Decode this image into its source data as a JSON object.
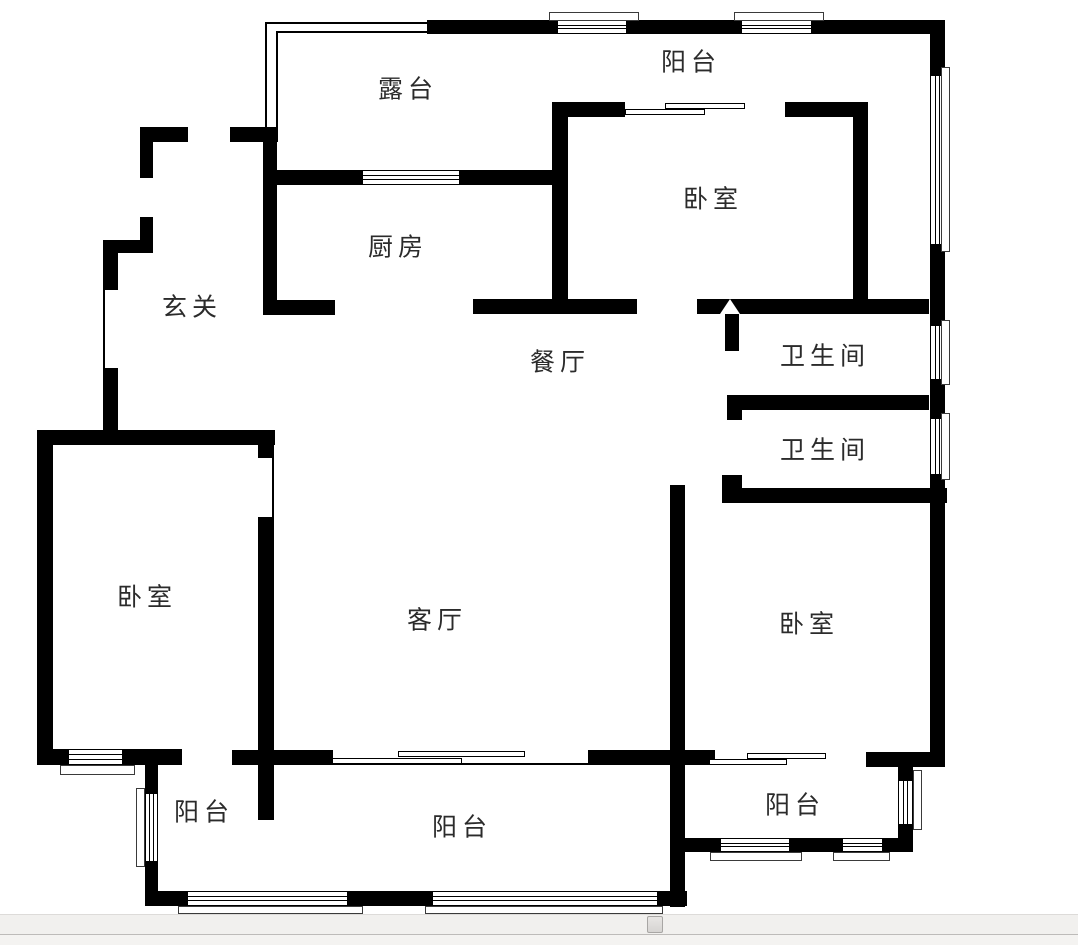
{
  "page": {
    "width": 1078,
    "height": 945,
    "background": "#ffffff"
  },
  "floorplan": {
    "wall_color": "#000000",
    "label_color": "#2b2b2b",
    "rooms": [
      {
        "id": "terrace",
        "label": "露台",
        "x": 408,
        "y": 90
      },
      {
        "id": "balcony-top",
        "label": "阳台",
        "x": 691,
        "y": 63
      },
      {
        "id": "bedroom-ne",
        "label": "卧室",
        "x": 713,
        "y": 200
      },
      {
        "id": "kitchen",
        "label": "厨房",
        "x": 398,
        "y": 248
      },
      {
        "id": "foyer",
        "label": "玄关",
        "x": 192,
        "y": 308
      },
      {
        "id": "dining-room",
        "label": "餐厅",
        "x": 560,
        "y": 363
      },
      {
        "id": "bathroom-upper",
        "label": "卫生间",
        "x": 825,
        "y": 357
      },
      {
        "id": "bathroom-lower",
        "label": "卫生间",
        "x": 825,
        "y": 451
      },
      {
        "id": "bedroom-west",
        "label": "卧室",
        "x": 147,
        "y": 598
      },
      {
        "id": "living-room",
        "label": "客厅",
        "x": 437,
        "y": 621
      },
      {
        "id": "bedroom-se",
        "label": "卧室",
        "x": 809,
        "y": 625
      },
      {
        "id": "balcony-sw",
        "label": "阳台",
        "x": 204,
        "y": 813
      },
      {
        "id": "balcony-s",
        "label": "阳台",
        "x": 462,
        "y": 828
      },
      {
        "id": "balcony-se",
        "label": "阳台",
        "x": 795,
        "y": 806
      }
    ],
    "geometry": {
      "walls": [
        [
          427,
          20,
          130,
          14
        ],
        [
          627,
          20,
          114,
          14
        ],
        [
          812,
          20,
          129,
          14
        ],
        [
          930,
          20,
          15,
          55
        ],
        [
          930,
          245,
          15,
          80
        ],
        [
          930,
          380,
          15,
          38
        ],
        [
          930,
          475,
          15,
          292
        ],
        [
          140,
          127,
          48,
          15
        ],
        [
          230,
          127,
          48,
          15
        ],
        [
          140,
          127,
          13,
          51
        ],
        [
          140,
          217,
          13,
          36
        ],
        [
          103,
          240,
          50,
          13
        ],
        [
          103,
          240,
          15,
          50
        ],
        [
          103,
          368,
          15,
          77
        ],
        [
          263,
          127,
          14,
          188
        ],
        [
          277,
          170,
          85,
          15
        ],
        [
          460,
          170,
          92,
          15
        ],
        [
          552,
          102,
          16,
          199
        ],
        [
          552,
          102,
          73,
          15
        ],
        [
          785,
          102,
          83,
          15
        ],
        [
          853,
          115,
          15,
          186
        ],
        [
          263,
          300,
          72,
          15
        ],
        [
          473,
          299,
          164,
          15
        ],
        [
          697,
          299,
          232,
          15
        ],
        [
          725,
          313,
          14,
          38
        ],
        [
          727,
          395,
          202,
          15
        ],
        [
          727,
          410,
          15,
          10
        ],
        [
          727,
          475,
          15,
          28
        ],
        [
          722,
          475,
          17,
          13
        ],
        [
          722,
          488,
          225,
          15
        ],
        [
          670,
          485,
          15,
          422
        ],
        [
          232,
          750,
          101,
          15
        ],
        [
          588,
          750,
          127,
          15
        ],
        [
          866,
          752,
          79,
          15
        ],
        [
          37,
          430,
          238,
          15
        ],
        [
          37,
          430,
          16,
          335
        ],
        [
          258,
          445,
          16,
          13
        ],
        [
          258,
          517,
          16,
          303
        ],
        [
          37,
          749,
          31,
          16
        ],
        [
          123,
          749,
          59,
          16
        ],
        [
          145,
          765,
          13,
          28
        ],
        [
          145,
          862,
          13,
          41
        ],
        [
          145,
          891,
          42,
          15
        ],
        [
          348,
          891,
          84,
          15
        ],
        [
          658,
          891,
          29,
          15
        ],
        [
          898,
          767,
          15,
          13
        ],
        [
          898,
          825,
          15,
          27
        ],
        [
          685,
          838,
          35,
          14
        ],
        [
          790,
          838,
          52,
          14
        ],
        [
          883,
          838,
          30,
          14
        ]
      ],
      "windows_h": [
        [
          557,
          20,
          70,
          14
        ],
        [
          741,
          20,
          71,
          14
        ],
        [
          362,
          170,
          98,
          15
        ],
        [
          68,
          749,
          55,
          16
        ],
        [
          187,
          891,
          161,
          15
        ],
        [
          432,
          891,
          226,
          15
        ],
        [
          720,
          838,
          70,
          14
        ],
        [
          842,
          838,
          41,
          14
        ]
      ],
      "windows_v": [
        [
          930,
          75,
          15,
          170
        ],
        [
          930,
          325,
          15,
          55
        ],
        [
          930,
          418,
          15,
          57
        ],
        [
          145,
          793,
          13,
          69
        ],
        [
          898,
          780,
          15,
          45
        ]
      ],
      "sills": [
        [
          549,
          12,
          90,
          9
        ],
        [
          734,
          12,
          90,
          9
        ],
        [
          941,
          67,
          9,
          185
        ],
        [
          941,
          320,
          9,
          65
        ],
        [
          941,
          413,
          9,
          67
        ],
        [
          60,
          765,
          75,
          10
        ],
        [
          136,
          788,
          9,
          79
        ],
        [
          178,
          906,
          185,
          8
        ],
        [
          425,
          906,
          238,
          8
        ],
        [
          913,
          770,
          9,
          60
        ],
        [
          710,
          852,
          92,
          9
        ],
        [
          833,
          852,
          57,
          9
        ]
      ],
      "door_panels": [
        [
          625,
          109,
          80,
          6
        ],
        [
          665,
          103,
          80,
          6
        ],
        [
          398,
          751,
          127,
          6
        ],
        [
          332,
          758,
          130,
          6
        ],
        [
          747,
          753,
          79,
          6
        ],
        [
          709,
          759,
          78,
          6
        ]
      ],
      "thin_lines": [
        [
          265,
          22,
          162,
          2
        ],
        [
          276,
          31,
          151,
          2
        ],
        [
          265,
          22,
          2,
          105
        ],
        [
          276,
          31,
          2,
          96
        ],
        [
          272,
          445,
          2,
          72
        ],
        [
          103,
          290,
          2,
          78
        ],
        [
          332,
          763,
          256,
          2
        ]
      ],
      "door_arrows": [
        {
          "x": 720,
          "y": 299,
          "w": 20,
          "h": 15,
          "direction": "up",
          "fill": "#ffffff"
        }
      ]
    }
  },
  "scrollbar": {
    "orientation": "horizontal",
    "track": {
      "y": 914,
      "h": 20,
      "color": "#f1f0ee"
    },
    "thumb": {
      "x": 647,
      "y": 915,
      "w": 16,
      "h": 17,
      "border": "#a8a6a4"
    },
    "lower_strip": {
      "y": 934,
      "h": 11,
      "color": "#f4f3f1"
    }
  }
}
